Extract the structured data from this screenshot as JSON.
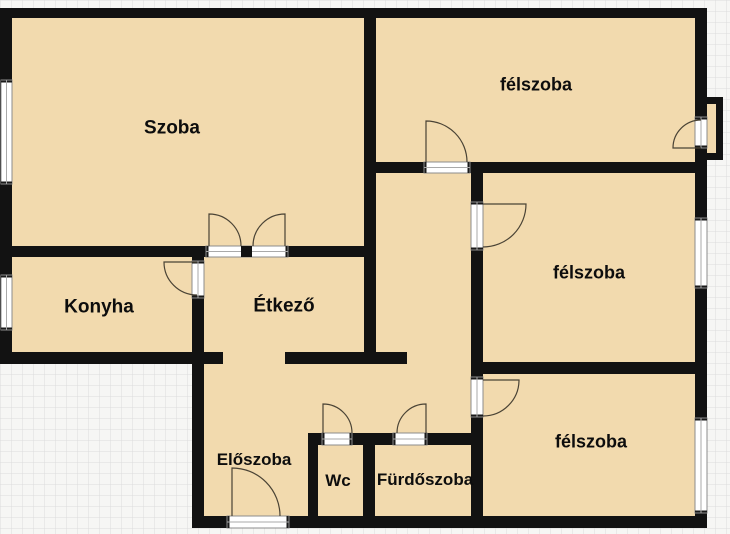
{
  "title": "Apartment floor plan",
  "colors": {
    "room_fill": "#F2DAAE",
    "wall": "#121212",
    "paper": "#F6F6F4",
    "grid_line": "#DCDCDC",
    "door_line": "#4A4335",
    "threshold_border": "#8C8C8C",
    "glazing_line": "#A9A9A9",
    "cap": "#1A1A1A",
    "label_color": "#0D0D0D"
  },
  "rooms": [
    {
      "id": "szoba",
      "label": "Szoba",
      "cx": 172,
      "cy": 127,
      "font": 19
    },
    {
      "id": "felszoba-top",
      "label": "félszoba",
      "cx": 536,
      "cy": 84,
      "font": 18
    },
    {
      "id": "felszoba-middle",
      "label": "félszoba",
      "cx": 589,
      "cy": 272,
      "font": 18
    },
    {
      "id": "felszoba-bottom",
      "label": "félszoba",
      "cx": 591,
      "cy": 441,
      "font": 18
    },
    {
      "id": "konyha",
      "label": "Konyha",
      "cx": 99,
      "cy": 306,
      "font": 19
    },
    {
      "id": "etkezo",
      "label": "Étkező",
      "cx": 284,
      "cy": 305,
      "font": 19
    },
    {
      "id": "eloszoba",
      "label": "Előszoba",
      "cx": 254,
      "cy": 459,
      "font": 17
    },
    {
      "id": "wc",
      "label": "Wc",
      "cx": 338,
      "cy": 480,
      "font": 17
    },
    {
      "id": "furdoszoba",
      "label": "Fürdőszoba",
      "cx": 425,
      "cy": 479,
      "font": 17
    }
  ],
  "plan": {
    "canvas": {
      "w": 730,
      "h": 534,
      "grid_step": 11
    },
    "floors": [
      {
        "x": 0,
        "y": 8,
        "w": 707,
        "h": 356
      },
      {
        "x": 192,
        "y": 352,
        "w": 515,
        "h": 176
      },
      {
        "x": 701,
        "y": 97,
        "w": 22,
        "h": 63
      }
    ],
    "walls": [
      {
        "x": 0,
        "y": 8,
        "w": 707,
        "h": 10
      },
      {
        "x": 0,
        "y": 8,
        "w": 12,
        "h": 356
      },
      {
        "x": 695,
        "y": 8,
        "w": 12,
        "h": 520
      },
      {
        "x": 0,
        "y": 246,
        "w": 376,
        "h": 11
      },
      {
        "x": 364,
        "y": 8,
        "w": 12,
        "h": 356
      },
      {
        "x": 364,
        "y": 162,
        "w": 343,
        "h": 11
      },
      {
        "x": 192,
        "y": 257,
        "w": 12,
        "h": 271
      },
      {
        "x": 0,
        "y": 352,
        "w": 223,
        "h": 12
      },
      {
        "x": 285,
        "y": 352,
        "w": 122,
        "h": 12
      },
      {
        "x": 471,
        "y": 173,
        "w": 12,
        "h": 355
      },
      {
        "x": 471,
        "y": 362,
        "w": 236,
        "h": 12
      },
      {
        "x": 308,
        "y": 433,
        "w": 163,
        "h": 12
      },
      {
        "x": 308,
        "y": 445,
        "w": 10,
        "h": 83
      },
      {
        "x": 363,
        "y": 445,
        "w": 12,
        "h": 83
      },
      {
        "x": 192,
        "y": 516,
        "w": 515,
        "h": 12
      },
      {
        "x": 701,
        "y": 97,
        "w": 22,
        "h": 7
      },
      {
        "x": 716,
        "y": 97,
        "w": 7,
        "h": 63
      },
      {
        "x": 701,
        "y": 153,
        "w": 22,
        "h": 7
      }
    ],
    "windows": [
      {
        "x": 1,
        "y": 80,
        "w": 11,
        "h": 104,
        "o": "v"
      },
      {
        "x": 1,
        "y": 275,
        "w": 11,
        "h": 55,
        "o": "v"
      },
      {
        "x": 695,
        "y": 218,
        "w": 12,
        "h": 70,
        "o": "v"
      },
      {
        "x": 695,
        "y": 418,
        "w": 12,
        "h": 95,
        "o": "v"
      }
    ],
    "door_thresholds": [
      {
        "x": 206,
        "y": 246,
        "w": 82,
        "h": 11,
        "o": "h"
      },
      {
        "x": 192,
        "y": 261,
        "w": 12,
        "h": 37,
        "o": "v"
      },
      {
        "x": 424,
        "y": 162,
        "w": 46,
        "h": 11,
        "o": "h"
      },
      {
        "x": 471,
        "y": 202,
        "w": 12,
        "h": 48,
        "o": "v"
      },
      {
        "x": 471,
        "y": 377,
        "w": 12,
        "h": 40,
        "o": "v"
      },
      {
        "x": 322,
        "y": 433,
        "w": 30,
        "h": 12,
        "o": "h"
      },
      {
        "x": 393,
        "y": 433,
        "w": 34,
        "h": 12,
        "o": "h"
      },
      {
        "x": 227,
        "y": 516,
        "w": 62,
        "h": 12,
        "o": "h"
      },
      {
        "x": 695,
        "y": 117,
        "w": 12,
        "h": 31,
        "o": "v"
      }
    ],
    "door_center_block": {
      "x": 241,
      "y": 246,
      "w": 11,
      "h": 11
    },
    "door_swings": [
      {
        "d": "M209,246 L209,214 A32,32 0 0 1 241,246"
      },
      {
        "d": "M285,246 L285,214 A32,32 0 0 0 253,246"
      },
      {
        "d": "M197,262 L164,262 A33,33 0 0 0 197,295"
      },
      {
        "d": "M426,162 L426,121 A41,41 0 0 1 467,162"
      },
      {
        "d": "M483,204 L526,204 A43,43 0 0 1 483,247"
      },
      {
        "d": "M483,380 L519,380 A36,36 0 0 1 483,416"
      },
      {
        "d": "M323,433 L323,404 A29,29 0 0 1 352,433"
      },
      {
        "d": "M426,433 L426,404 A29,29 0 0 0 397,433"
      },
      {
        "d": "M232,516 L232,468 A48,48 0 0 1 280,516"
      },
      {
        "d": "M701,148 L673,148 A28,28 0 0 1 701,120"
      }
    ]
  }
}
